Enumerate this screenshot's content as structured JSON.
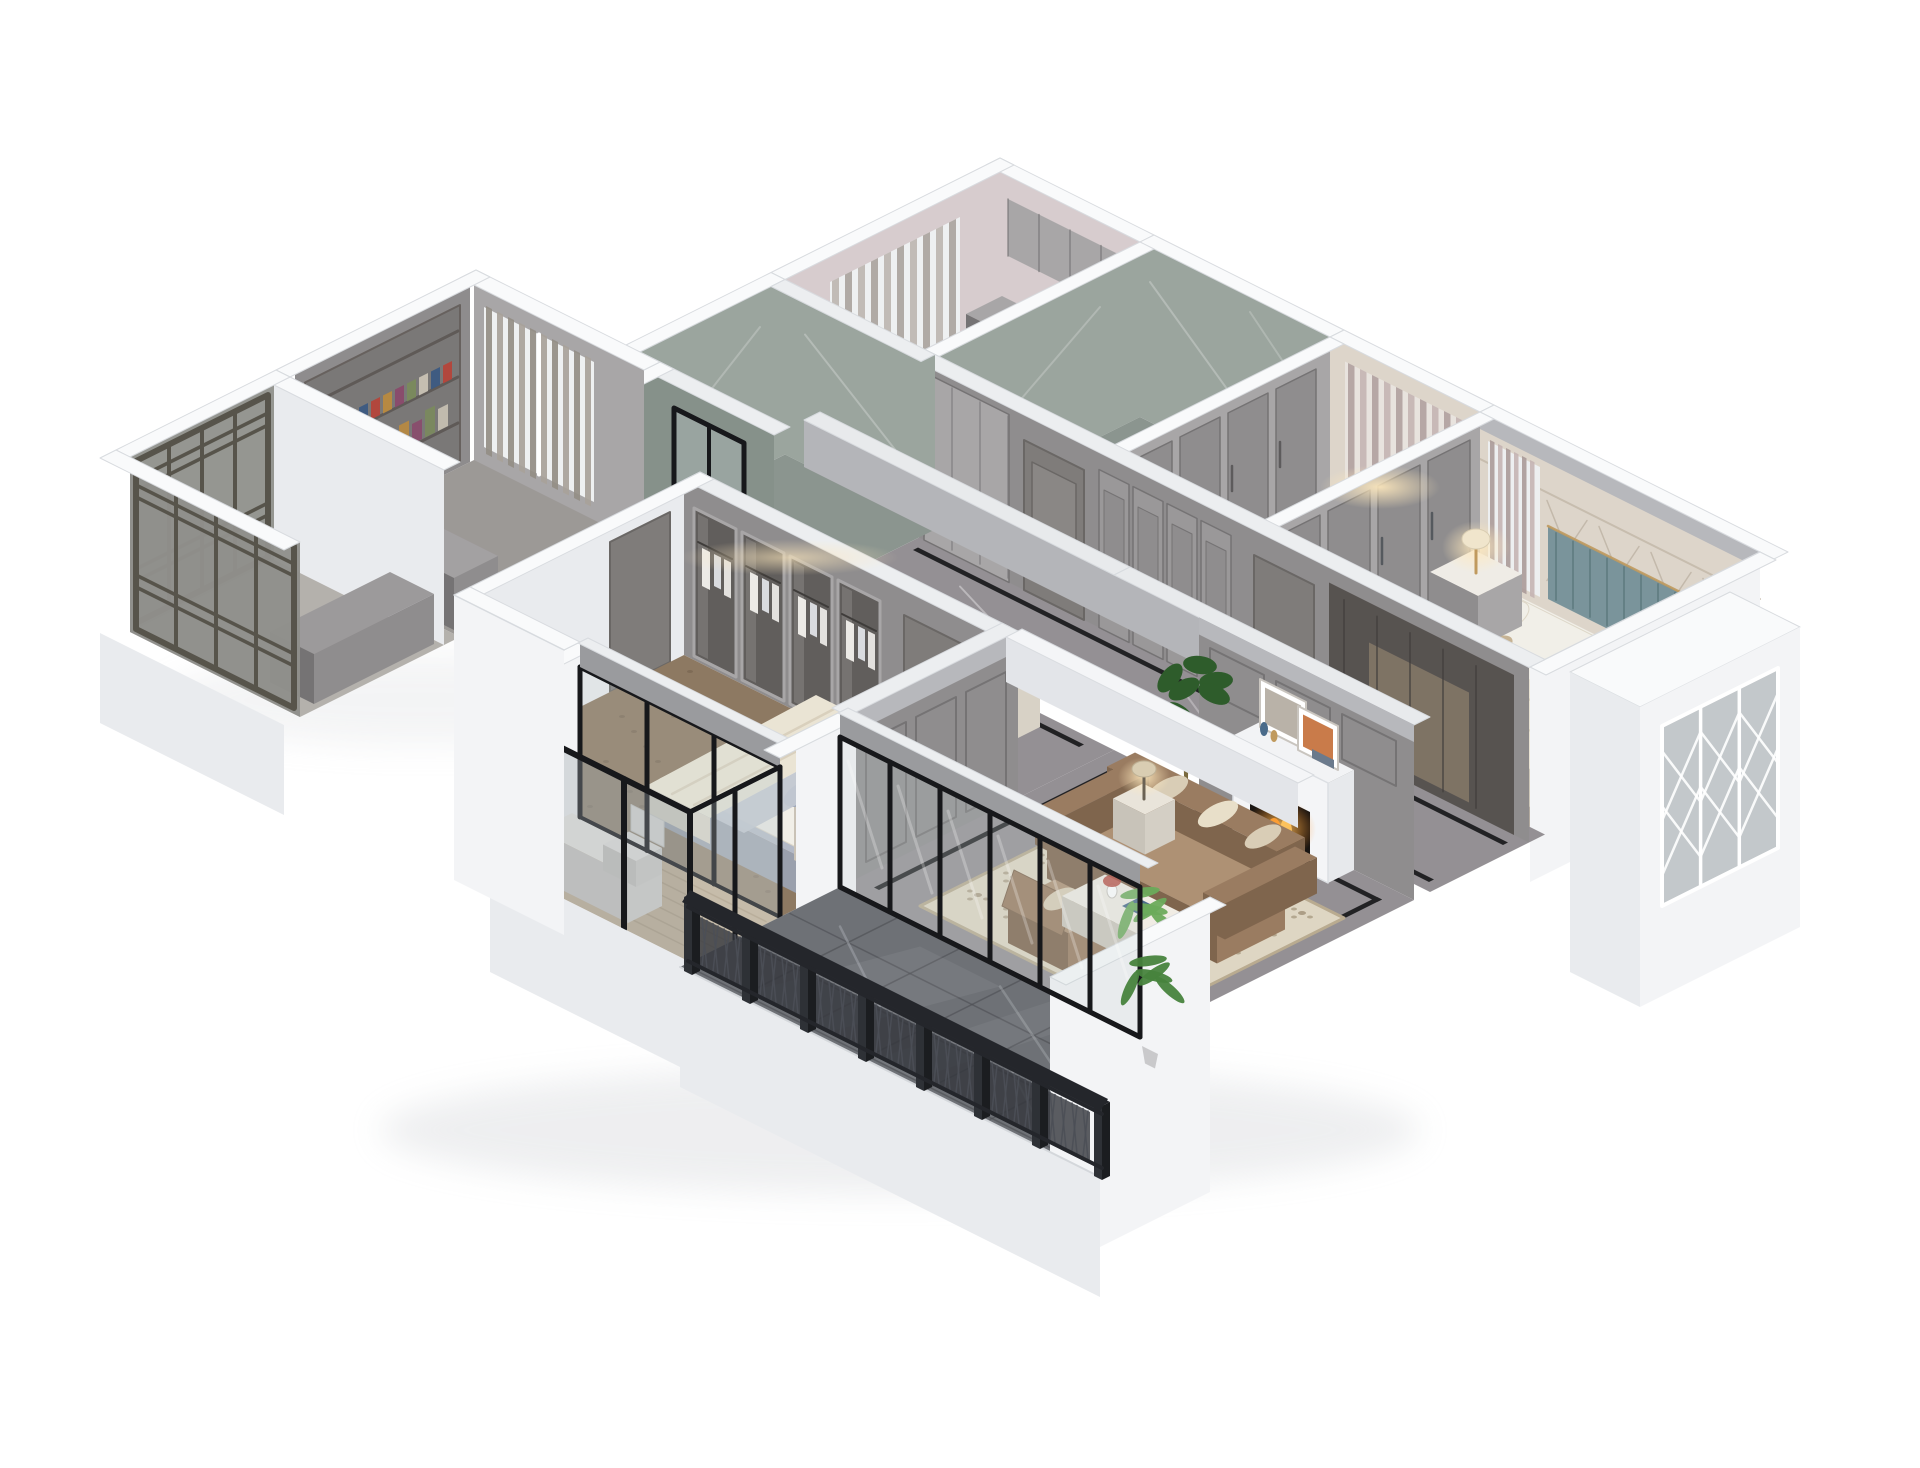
{
  "scene": {
    "kind": "isometric-3d-apartment-cutaway-render",
    "style": "light neoclassical interior, white cut walls, grey panelling, dark marble floors",
    "background_color": "#ffffff",
    "rooms": [
      {
        "id": "utility",
        "name": "utility-room",
        "features": [
          "grey cabinets",
          "upper cabinets",
          "curtained window"
        ]
      },
      {
        "id": "bathroom2",
        "name": "bathroom-large",
        "features": [
          "grey-green marble walls",
          "black glass door"
        ]
      },
      {
        "id": "closet",
        "name": "walk-in-closet",
        "features": [
          "grey wardrobes",
          "curtained back window"
        ]
      },
      {
        "id": "bedroom2",
        "name": "bedroom-right",
        "features": [
          "teal channel headboard",
          "diamond panel wall",
          "bed with white pillows",
          "wardrobe",
          "nightstand lamp",
          "floor lamp",
          "bay window with lattice"
        ]
      },
      {
        "id": "corridor",
        "name": "hallway",
        "features": [
          "dark marble floor with black inlay",
          "entry cabinet",
          "grey panel doors",
          "built-in wardrobe"
        ]
      },
      {
        "id": "bathroom1",
        "name": "bathroom-small",
        "features": [
          "grey-green marble walls",
          "black glass door"
        ]
      },
      {
        "id": "study",
        "name": "study-kitchen",
        "features": [
          "bookshelf with books",
          "orange poster",
          "grey curtains window",
          "grey counter"
        ]
      },
      {
        "id": "kitchen_balcony",
        "name": "lattice-balcony",
        "features": [
          "dark lattice screens",
          "grey cabinet"
        ]
      },
      {
        "id": "dining",
        "name": "dining-area",
        "features": [
          "white dining table",
          "six cross-back chairs",
          "place settings"
        ]
      },
      {
        "id": "living",
        "name": "living-room",
        "features": [
          "brown leather sofa",
          "cream quatrefoil rug",
          "white coffee table",
          "fireplace with fire",
          "framed art",
          "monstera plant",
          "side lamp",
          "ottoman"
        ]
      },
      {
        "id": "master",
        "name": "master-bedroom",
        "features": [
          "glass-door wardrobe with clothes",
          "bed with blue-grey pillows",
          "nightstand lamp",
          "brown carpet floor"
        ]
      },
      {
        "id": "master_balcony",
        "name": "master-balcony",
        "features": [
          "wood plank floor",
          "white desk and chair",
          "black framed glazing"
        ]
      },
      {
        "id": "terrace",
        "name": "terrace",
        "features": [
          "dark marble tiles",
          "black lattice railing",
          "sliding glass wall",
          "palm plant"
        ]
      }
    ]
  },
  "palette": {
    "bg": "#ffffff",
    "wall_white": "#f3f4f6",
    "wall_white_2": "#e9ebee",
    "wall_cap": "#f9fafb",
    "wall_edge": "#d8dbdf",
    "wall_shade": "#cdd0d6",
    "grey_panel": "#8f8d8e",
    "grey_panel_light": "#a8a6a7",
    "grey_panel_dark": "#757374",
    "grey_door": "#7f7c7a",
    "grey_crown": "#b7b8bc",
    "marble_floor": "#949094",
    "marble_floor_dark": "#7d797d",
    "marble_vein": "#e2dfe2",
    "inlay_black": "#222224",
    "terrace_floor": "#6e7176",
    "terrace_floor_dark": "#595c61",
    "terrace_vein": "#a6aab0",
    "terrace_seam": "#4c4f54",
    "bath_wall": "#9ba59e",
    "bath_wall_dark": "#86918a",
    "bath_floor": "#8b958f",
    "util_wall": "#d7ccce",
    "util_floor": "#c8c0bd",
    "cream_panel": "#ddd5ca",
    "cream_panel_line": "#bdb2a2",
    "teal_headboard": "#7a949b",
    "brass": "#c09a5e",
    "carpet_beige": "#b3aba0",
    "bed_white": "#f1efe8",
    "pillow_blue": "#9ca6b8",
    "pillow_tan": "#c6b394",
    "blanket": "#eae4d4",
    "bed_base": "#b4bac7",
    "throw_grey": "#c2c7d1",
    "master_floor": "#8d7962",
    "master_floor_dot": "#6f5e4a",
    "wood_floor": "#c6b69c",
    "wood_line": "#ab9a7f",
    "sofa": "#9a7c61",
    "sofa_dark": "#7f654d",
    "sofa_light": "#ae9174",
    "cushion_cream": "#d9cdb6",
    "rug": "#ded6c3",
    "rug_border": "#b9ab90",
    "rug_pattern": "#a3947b",
    "table_white": "#ece7dd",
    "chair_cream": "#e6e0d3",
    "plate_grey": "#c2c7cc",
    "frame_black": "#17181b",
    "glass_tint": "#c6d0d3",
    "glass_dark": "#9aa4a8",
    "lattice_frame": "#57544b",
    "lattice_glass": "#8f908b",
    "rail_black": "#24262b",
    "rail_mesh": "#33363c",
    "rail_line": "#4b4f56",
    "green_dark": "#2e5c2b",
    "green_mid": "#47833d",
    "green_light": "#6cab5b",
    "pot_white": "#e9e9ea",
    "fire": "#ff9e33",
    "fire_deep": "#e2591c",
    "lamp_glow": "#ffe9bd",
    "lamp_shade": "#f0e5cc",
    "book_colors": [
      "#b5453a",
      "#3c5a82",
      "#c9c2b4",
      "#7a8a5c",
      "#8a4a6b",
      "#b98a3f"
    ],
    "shadow": "#c3c6cb"
  }
}
